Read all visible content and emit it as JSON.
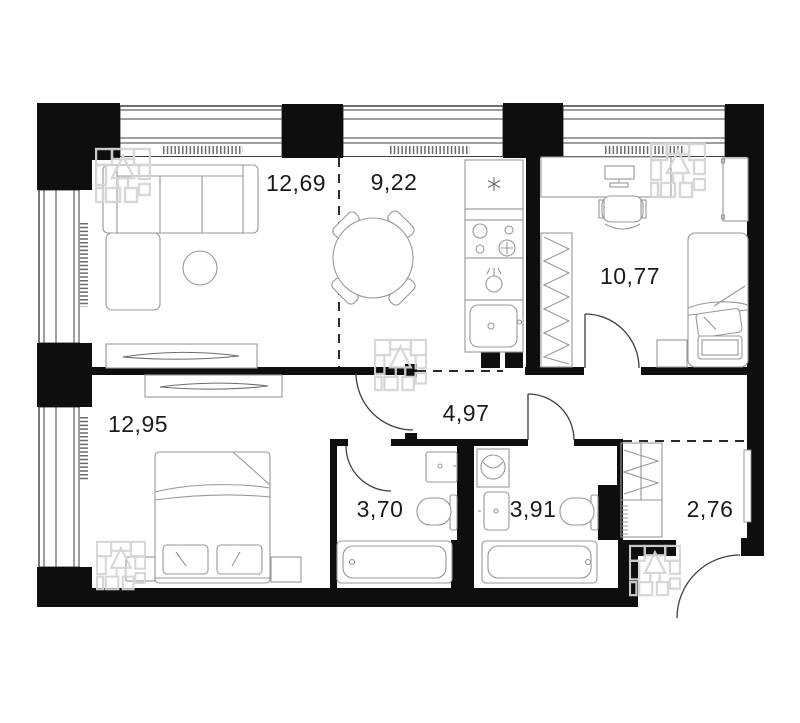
{
  "plan": {
    "type": "apartment-floor-plan",
    "rooms": [
      {
        "name": "living-room",
        "area_label": "12,69"
      },
      {
        "name": "kitchen",
        "area_label": "9,22"
      },
      {
        "name": "bedroom-right",
        "area_label": "10,77"
      },
      {
        "name": "bedroom-left",
        "area_label": "12,95"
      },
      {
        "name": "hallway",
        "area_label": "4,97"
      },
      {
        "name": "bathroom-left",
        "area_label": "3,70"
      },
      {
        "name": "bathroom-right",
        "area_label": "3,91"
      },
      {
        "name": "entrance-hall",
        "area_label": "2,76"
      }
    ],
    "colors": {
      "walls": "#0e0e0e",
      "thin_lines": "#3f3f3f",
      "furniture": "#989898",
      "labels": "#1b1b1b",
      "watermark": "#d5d5d5",
      "background": "#ffffff"
    }
  }
}
